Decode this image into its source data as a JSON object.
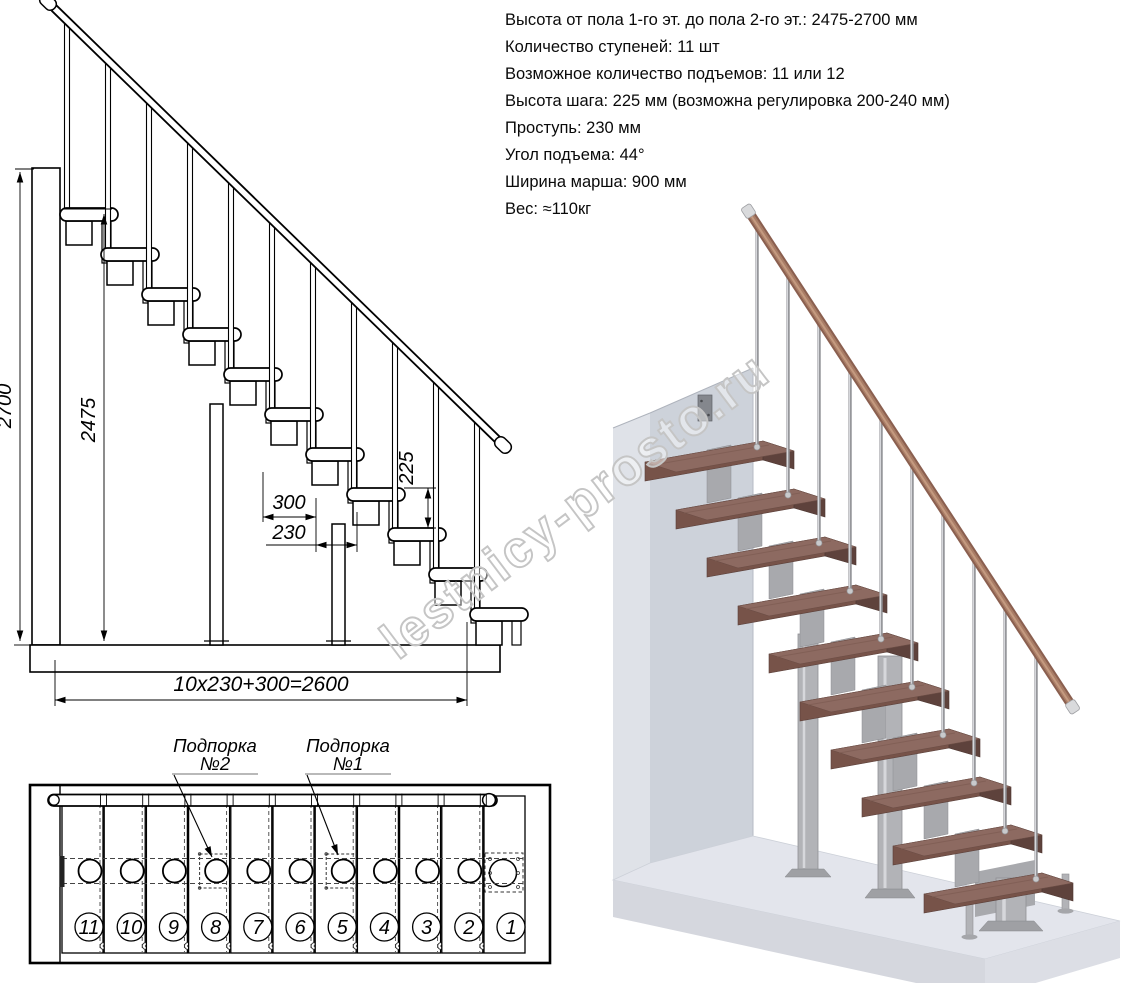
{
  "specs": {
    "lines": [
      "Высота от пола 1-го эт. до пола 2-го эт.: 2475-2700 мм",
      "Количество ступеней: 11 шт",
      "Возможное количество подъемов: 11 или 12",
      "Высота шага: 225 мм (возможна регулировка 200-240 мм)",
      "Проступь: 230 мм",
      "Угол подъема: 44°",
      "Ширина марша: 900 мм",
      "Вес: ≈110кг"
    ]
  },
  "elevation": {
    "step_count": 11,
    "dim_total_height": "2700",
    "dim_tread_height": "2475",
    "dim_top_run": "300",
    "dim_tread_depth": "230",
    "dim_riser": "225",
    "dim_total_run": "10x230+300=2600"
  },
  "plan": {
    "support_word": "Подпорка",
    "support2_num": "№2",
    "support1_num": "№1",
    "step_numbers": [
      "11",
      "10",
      "9",
      "8",
      "7",
      "6",
      "5",
      "4",
      "3",
      "2",
      "1"
    ],
    "support1_step_index": 6,
    "support2_step_index": 3
  },
  "render3d": {
    "tread_count": 10
  },
  "watermark": {
    "text": "lestnicy-prosto.ru"
  },
  "colors": {
    "line": "#000000",
    "wood_top": "#8d6a61",
    "wood_front": "#775349",
    "wood_side": "#5e423c",
    "rail_dark": "#8a5f4f",
    "rail_mid": "#a97d66",
    "rail_light": "#c49a80",
    "metal_fill": "#b2b3b7",
    "metal_edge": "#8f9094",
    "metal_hi": "#d6d7db",
    "wall_front": "#cdd2da",
    "wall_side": "#dfe2e8",
    "floor_top": "#e3e5ec",
    "floor_front": "#d5d7de",
    "floor_side": "#dcdee5",
    "watermark": "#c5c5c5"
  }
}
